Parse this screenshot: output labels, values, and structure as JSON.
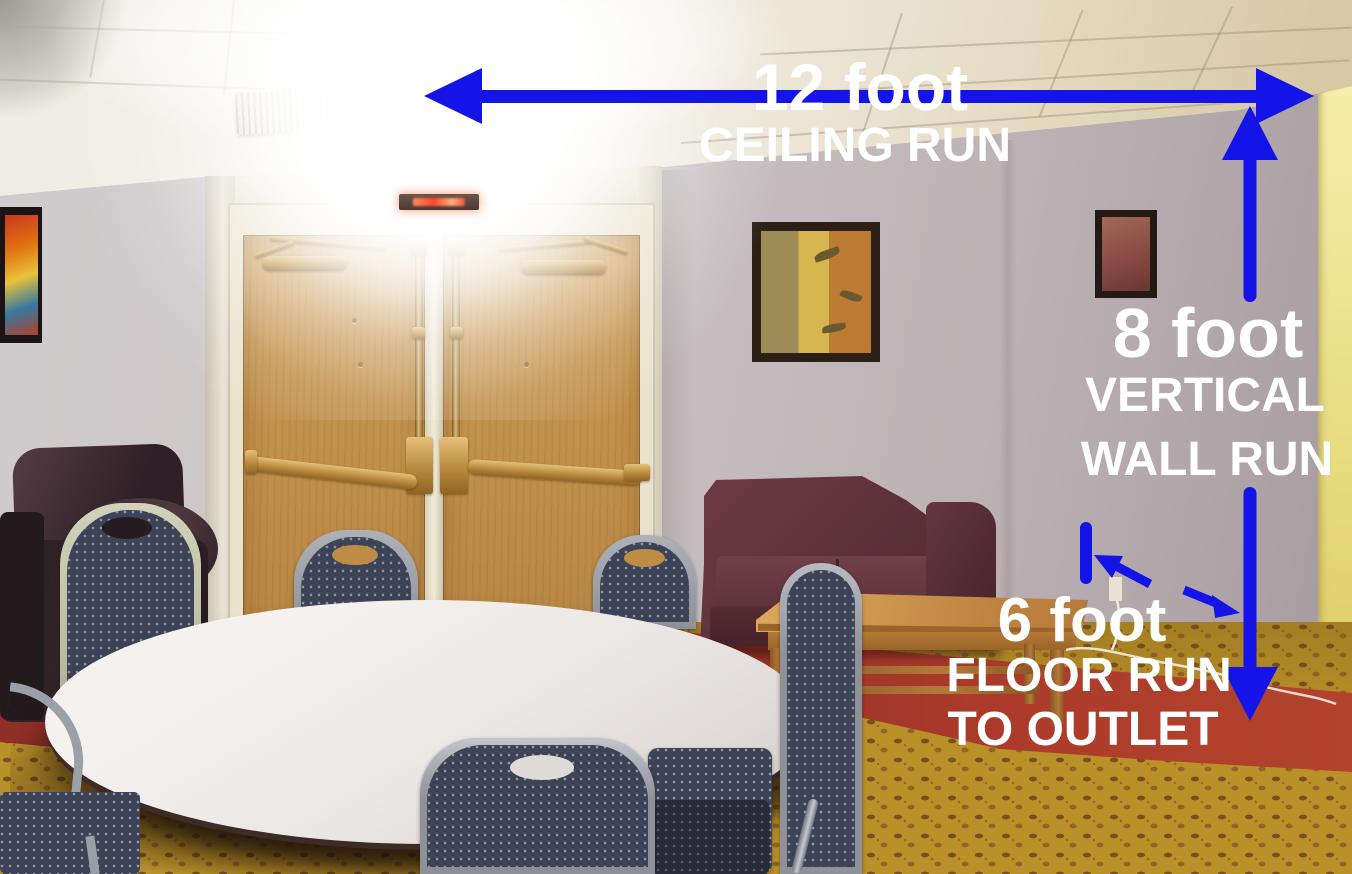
{
  "scene": {
    "type": "annotated-room-photograph",
    "annotation_arrow_color": "#1414e8",
    "annotation_text_color": "#ffffff"
  },
  "annotations": {
    "ceiling_run": {
      "measurement": "12 foot",
      "label": "CEILING RUN"
    },
    "vertical_wall_run": {
      "measurement": "8 foot",
      "label_line1": "VERTICAL",
      "label_line2": "WALL RUN"
    },
    "floor_run": {
      "measurement": "6 foot",
      "label_line1": "FLOOR RUN",
      "label_line2": "TO OUTLET"
    }
  }
}
